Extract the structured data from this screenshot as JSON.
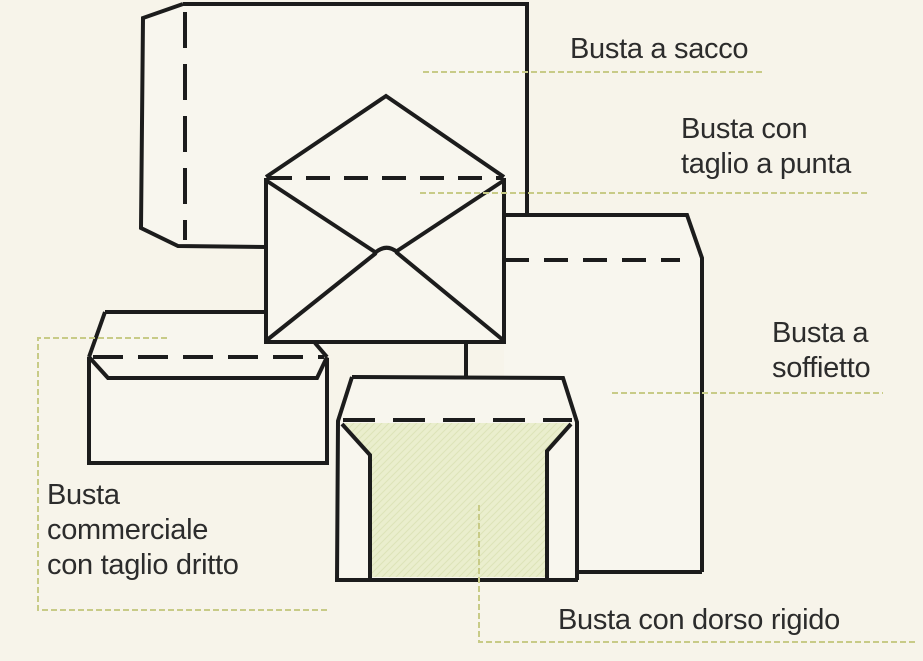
{
  "diagram": {
    "labels": {
      "busta_a_sacco": {
        "lines": [
          "Busta a sacco"
        ]
      },
      "busta_con_taglio_a_punta": {
        "lines": [
          "Busta con",
          "taglio a punta"
        ]
      },
      "busta_a_soffietto": {
        "lines": [
          "Busta a",
          "soffietto"
        ]
      },
      "busta_commerciale": {
        "lines": [
          "Busta",
          "commerciale",
          "con taglio dritto"
        ]
      },
      "busta_con_dorso_rigido": {
        "lines": [
          "Busta con dorso rigido"
        ]
      }
    },
    "colors": {
      "paper_background": "#f7f4ea",
      "ink": "#1c1c1c",
      "leader_line": "#c8cb87",
      "envelope_interior_fill": "#eaeecd",
      "label_text": "#2c2c2c"
    }
  }
}
